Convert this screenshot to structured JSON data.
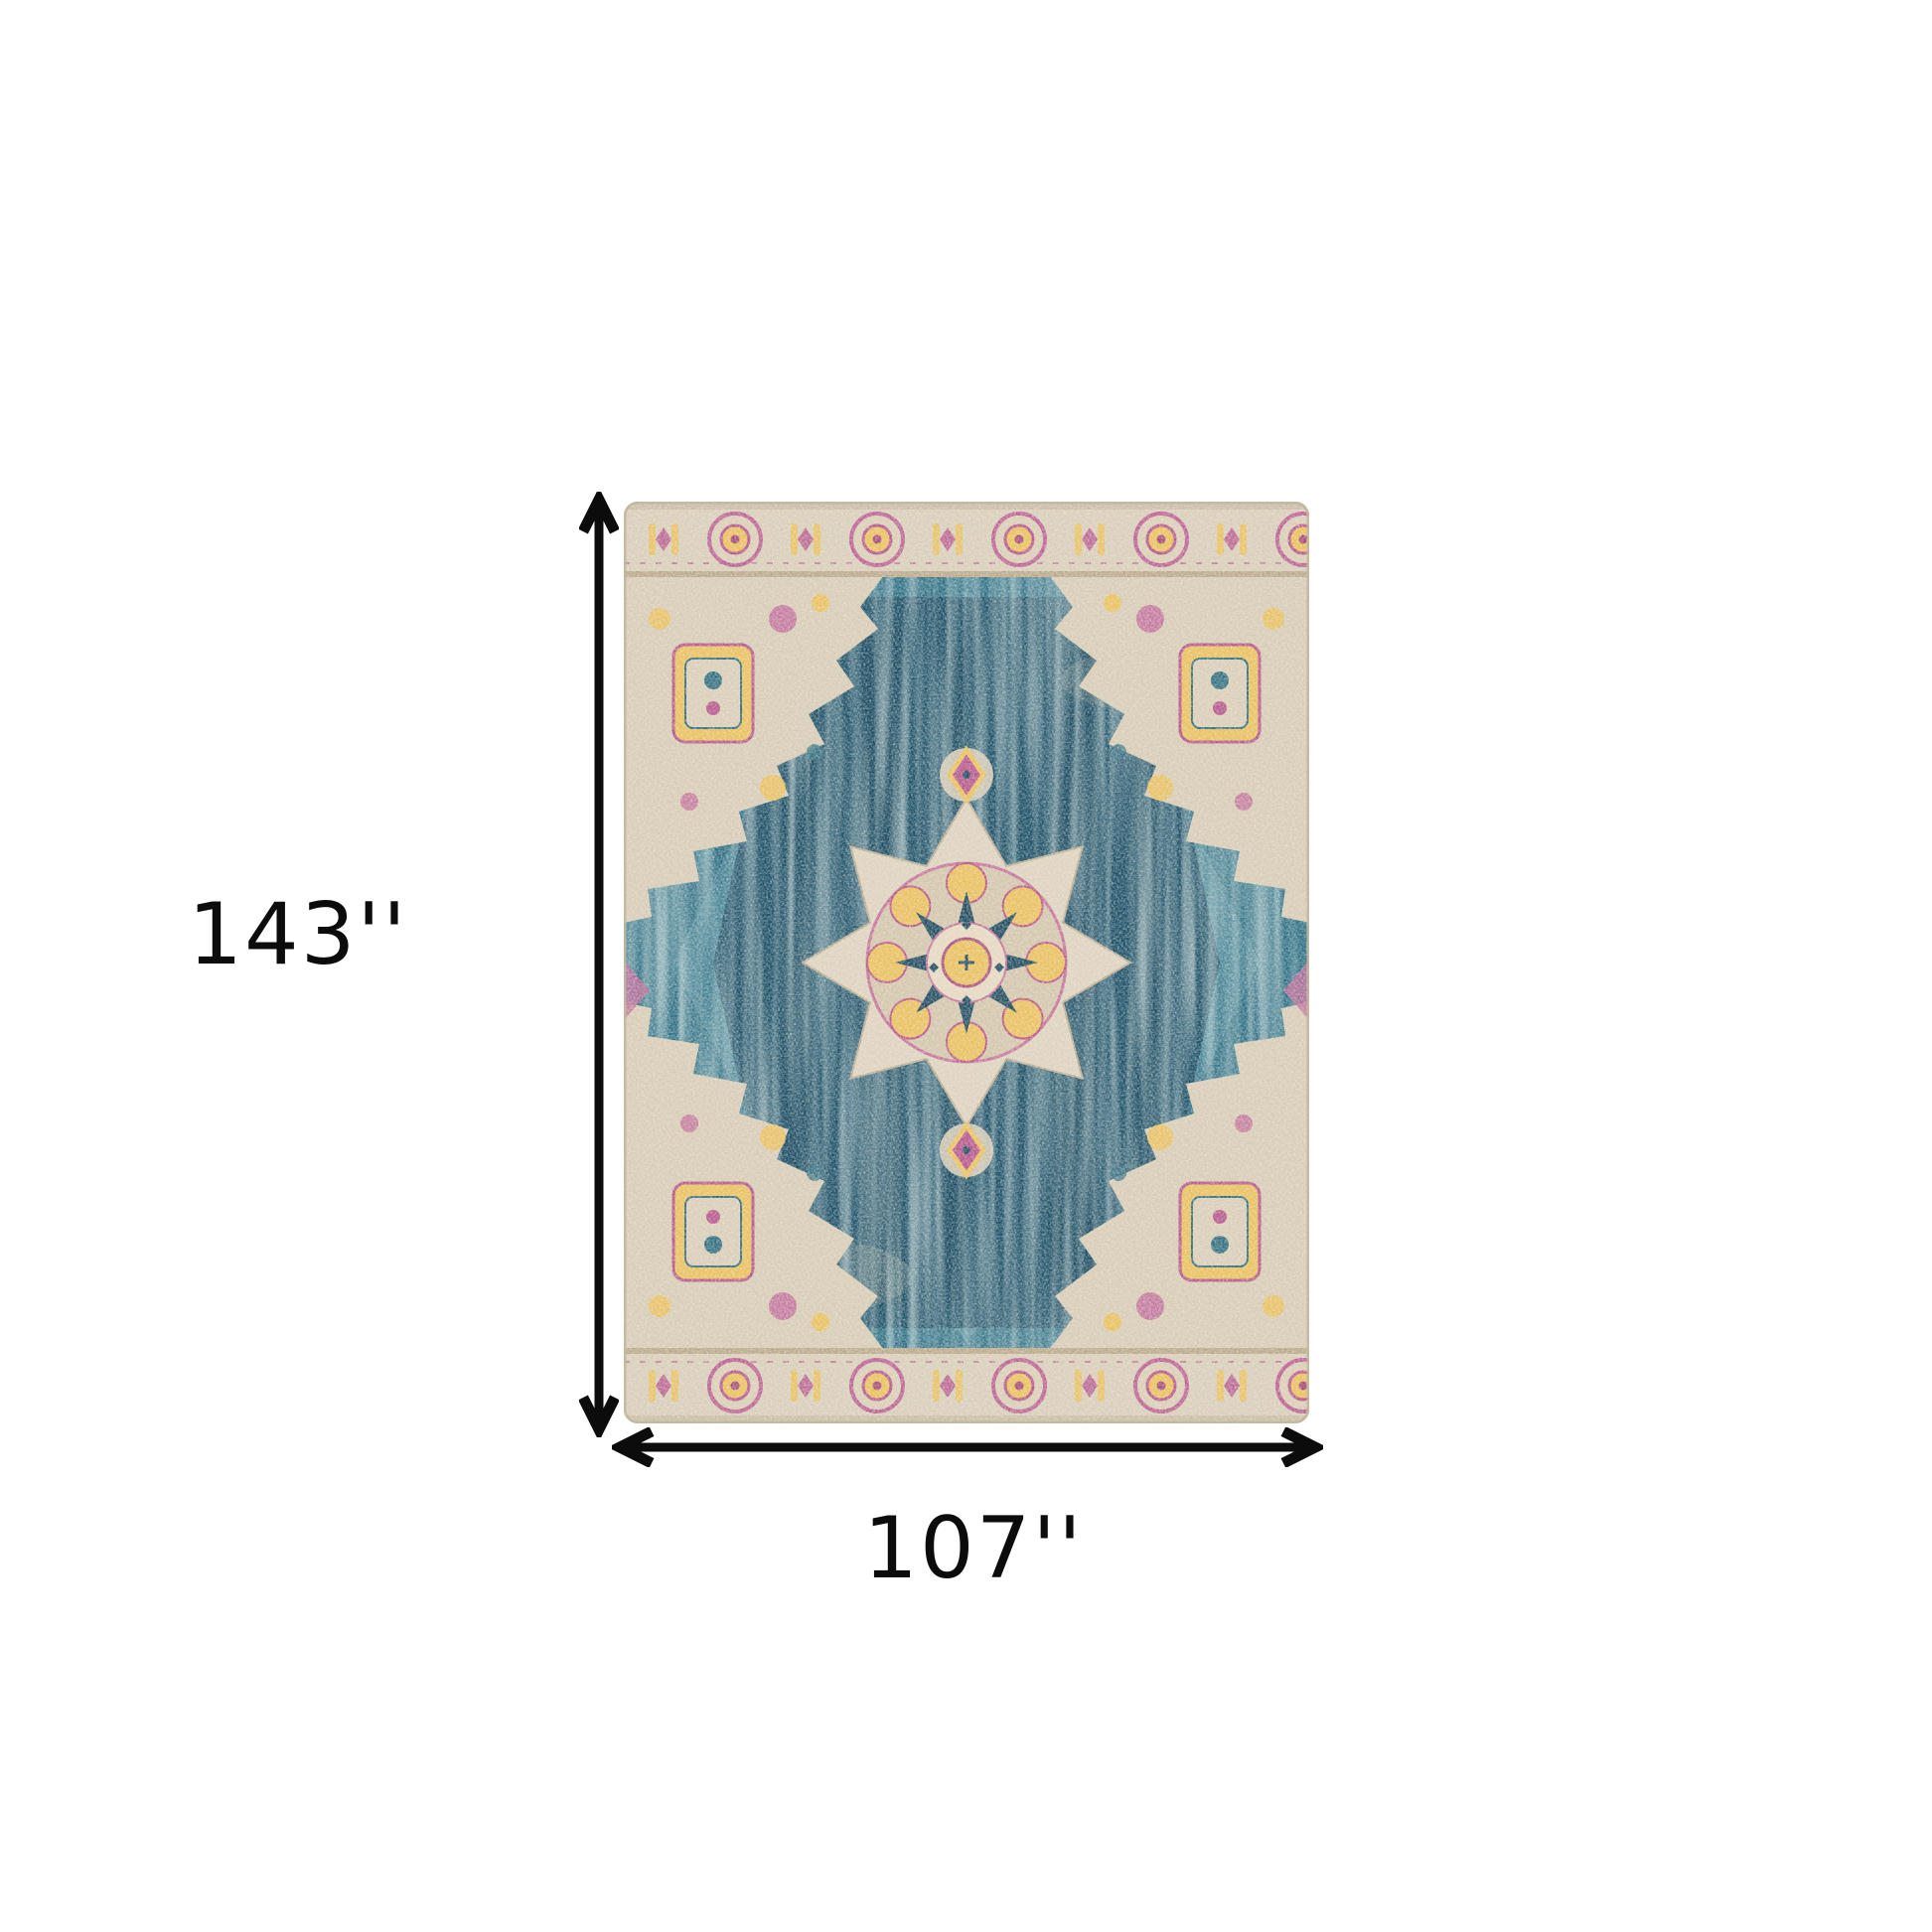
{
  "diagram": {
    "subject": "distressed-medallion-area-rug",
    "dimensions": {
      "height_label": "143''",
      "width_label": "107''"
    },
    "icons": {
      "height_arrow": "vertical-double-arrow-icon",
      "width_arrow": "horizontal-double-arrow-icon",
      "rug": "distressed-medallion-rug-image"
    },
    "colors": {
      "background": "#ffffff",
      "annotation": "#0c0c0c",
      "rug_field_teal": "#2a6d84",
      "rug_field_dark": "#1a4f68",
      "rug_cream": "#d8cdba",
      "rug_yellow": "#e9c05e",
      "rug_pink": "#b5568d",
      "rug_navy": "#1d4a61"
    }
  }
}
